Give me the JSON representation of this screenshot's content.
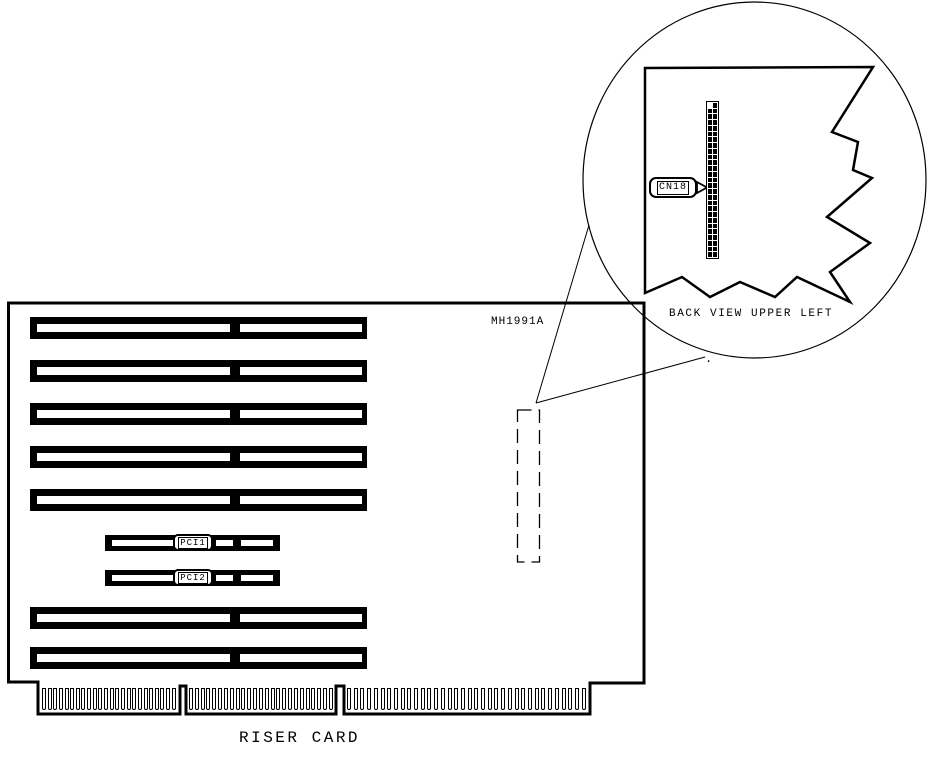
{
  "title": "RISER CARD",
  "board": {
    "part_number": "MH1991A",
    "slots": {
      "isa_count": 7,
      "pci": [
        {
          "label": "PCI1"
        },
        {
          "label": "PCI2"
        }
      ]
    },
    "edge_connector": {
      "finger_groups": [
        24,
        25,
        36
      ]
    }
  },
  "inset": {
    "caption": "BACK VIEW UPPER LEFT",
    "connector": {
      "label": "CN18",
      "pin_columns": 2,
      "pin_rows": 27,
      "pin_cells": 54
    }
  },
  "colors": {
    "ink": "#000000",
    "paper": "#ffffff"
  },
  "stray_dot": "."
}
